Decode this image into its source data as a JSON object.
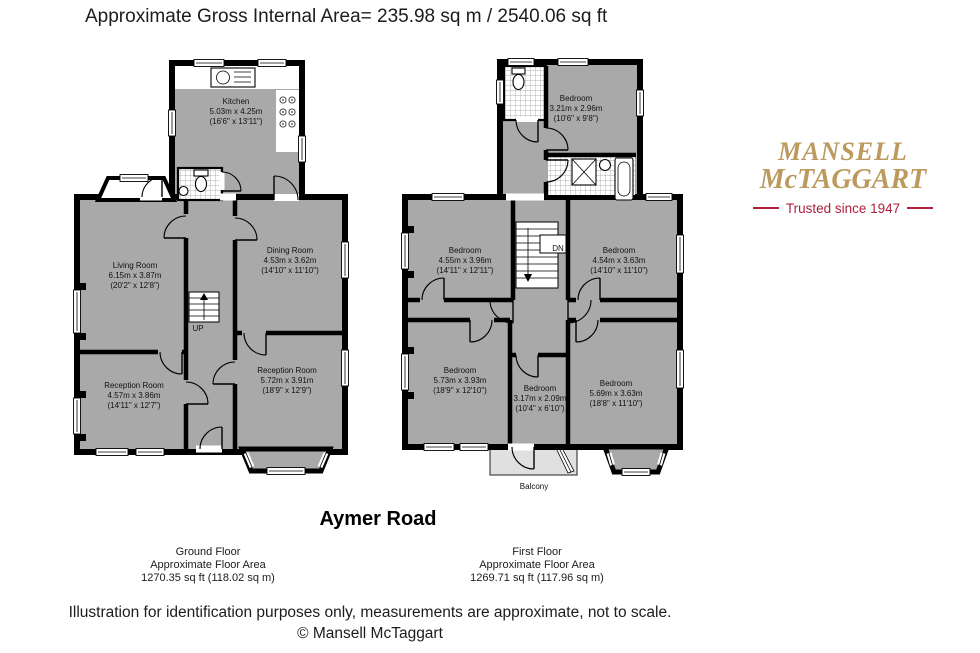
{
  "header": {
    "gross_internal_area": "Approximate Gross Internal Area= 235.98 sq m / 2540.06 sq ft"
  },
  "logo": {
    "line1": "MANSELL",
    "line2": "McTAGGART",
    "tagline": "Trusted since 1947"
  },
  "property_title": "Aymer Road",
  "ground_floor": {
    "caption": {
      "line1": "Ground Floor",
      "line2": "Approximate Floor Area",
      "line3": "1270.35 sq ft (118.02 sq m)"
    },
    "rooms": {
      "kitchen": {
        "name": "Kitchen",
        "metric": "5.03m x 4.25m",
        "imperial": "(16'6\" x 13'11\")"
      },
      "living_room": {
        "name": "Living Room",
        "metric": "6.15m x 3.87m",
        "imperial": "(20'2\" x 12'8\")"
      },
      "dining_room": {
        "name": "Dining Room",
        "metric": "4.53m x 3.62m",
        "imperial": "(14'10\" x 11'10\")"
      },
      "reception_room_1": {
        "name": "Reception Room",
        "metric": "4.57m x 3.86m",
        "imperial": "(14'11\" x 12'7\")"
      },
      "reception_room_2": {
        "name": "Reception Room",
        "metric": "5.72m x 3.91m",
        "imperial": "(18'9\" x 12'9\")"
      }
    },
    "stairs_label": "UP"
  },
  "first_floor": {
    "caption": {
      "line1": "First Floor",
      "line2": "Approximate Floor Area",
      "line3": "1269.71 sq ft (117.96 sq m)"
    },
    "rooms": {
      "bedroom_top": {
        "name": "Bedroom",
        "metric": "3.21m x 2.96m",
        "imperial": "(10'6\" x 9'8\")"
      },
      "bedroom_mid_left": {
        "name": "Bedroom",
        "metric": "4.55m x 3.96m",
        "imperial": "(14'11\" x 12'11\")"
      },
      "bedroom_mid_right": {
        "name": "Bedroom",
        "metric": "4.54m x 3.63m",
        "imperial": "(14'10\" x 11'10\")"
      },
      "bedroom_bottom_left": {
        "name": "Bedroom",
        "metric": "5.73m x 3.93m",
        "imperial": "(18'9\" x 12'10\")"
      },
      "bedroom_bottom_middle": {
        "name": "Bedroom",
        "metric": "3.17m x 2.09m",
        "imperial": "(10'4\" x 6'10\")"
      },
      "bedroom_bottom_right": {
        "name": "Bedroom",
        "metric": "5.69m x 3.63m",
        "imperial": "(18'8\" x 11'10\")"
      }
    },
    "stairs_label": "DN",
    "balcony_label": "Balcony"
  },
  "footer": {
    "disclaimer": "Illustration for identification purposes only, measurements are approximate, not to scale.",
    "copyright": "© Mansell McTaggart"
  },
  "colors": {
    "room_fill": "#a9a9a9",
    "balcony_fill": "#e0e0e0",
    "wall": "#000000",
    "logo_gold": "#bc9a5e",
    "logo_red": "#b0203e",
    "page_bg": "#ffffff"
  }
}
